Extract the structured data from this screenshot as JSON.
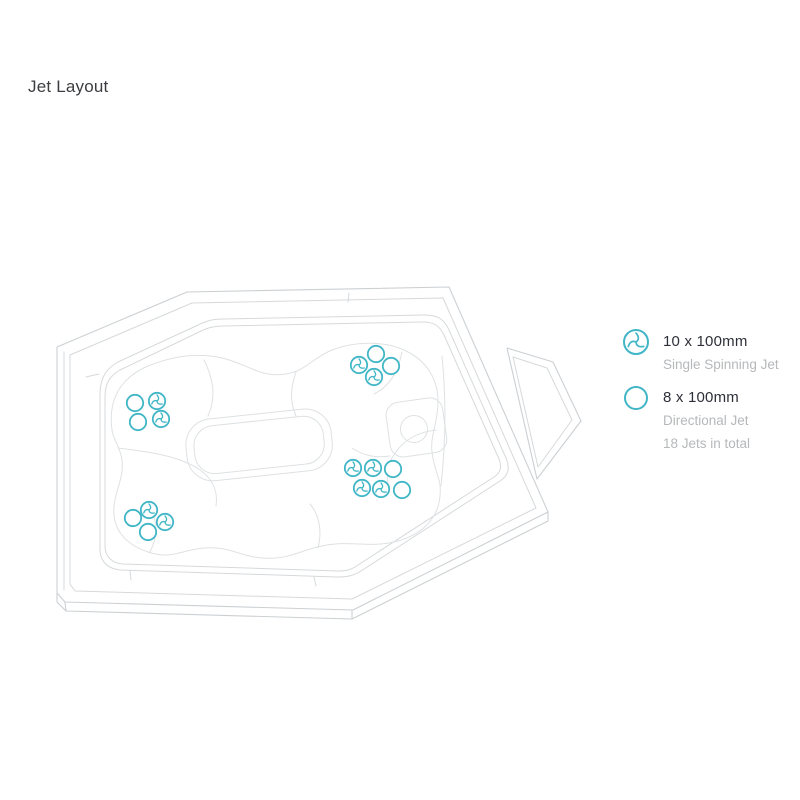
{
  "page": {
    "title": "Jet Layout",
    "background": "#ffffff"
  },
  "colors": {
    "accent_teal": "#41b6c6",
    "line_gray": "#ccd0d3",
    "text_dark": "#2d3038",
    "text_muted": "#b6b8ba"
  },
  "legend": {
    "item1": {
      "icon": "single-spinning-jet-icon",
      "size_label": "10 x 100mm",
      "type_label": "Single Spinning Jet"
    },
    "item2": {
      "icon": "directional-jet-icon",
      "size_label": "8 x 100mm",
      "type_label": "Directional Jet",
      "total_label": "18 Jets in total"
    }
  },
  "diagram": {
    "description": "Top view line drawing of hot tub with jet positions",
    "jet_counts": {
      "single_spinning": 10,
      "directional": 8,
      "total": 18
    },
    "jets": [
      {
        "type": "directional",
        "x": 135,
        "y": 403
      },
      {
        "type": "spinning",
        "x": 157,
        "y": 401
      },
      {
        "type": "directional",
        "x": 138,
        "y": 422
      },
      {
        "type": "spinning",
        "x": 161,
        "y": 419
      },
      {
        "type": "directional",
        "x": 376,
        "y": 354
      },
      {
        "type": "spinning",
        "x": 359,
        "y": 365
      },
      {
        "type": "directional",
        "x": 391,
        "y": 366
      },
      {
        "type": "spinning",
        "x": 374,
        "y": 377
      },
      {
        "type": "spinning",
        "x": 353,
        "y": 468
      },
      {
        "type": "spinning",
        "x": 373,
        "y": 468
      },
      {
        "type": "directional",
        "x": 393,
        "y": 469
      },
      {
        "type": "spinning",
        "x": 362,
        "y": 488
      },
      {
        "type": "spinning",
        "x": 381,
        "y": 489
      },
      {
        "type": "directional",
        "x": 402,
        "y": 490
      },
      {
        "type": "spinning",
        "x": 149,
        "y": 510
      },
      {
        "type": "directional",
        "x": 133,
        "y": 518
      },
      {
        "type": "spinning",
        "x": 165,
        "y": 522
      },
      {
        "type": "directional",
        "x": 148,
        "y": 532
      }
    ]
  }
}
